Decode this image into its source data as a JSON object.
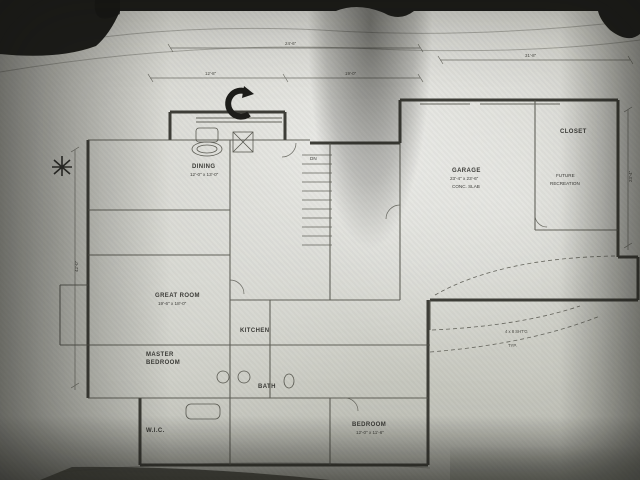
{
  "photo": {
    "subject": "architectural floor plan blueprint photograph"
  },
  "colors": {
    "paper": "#d0d1c9",
    "background": "#22221f",
    "wall_line": "#45453f",
    "thin_line": "#7b7b73"
  },
  "plan": {
    "rooms": {
      "great_room": {
        "label": "GREAT ROOM",
        "size": "19'-6\" x 18'-0\""
      },
      "master": {
        "label": "MASTER",
        "label2": "BEDROOM"
      },
      "dining": {
        "label": "DINING",
        "size": "12'-0\" x 13'-0\""
      },
      "kitchen": {
        "label": "KITCHEN"
      },
      "bath": {
        "label": "BATH"
      },
      "wic": {
        "label": "W.I.C."
      },
      "bedroom": {
        "label": "BEDROOM",
        "size": "12'-0\" x 11'-6\""
      },
      "garage": {
        "label": "GARAGE",
        "size": "23'-4\" x 23'-6\"",
        "note": "CONC. SLAB"
      },
      "closet": {
        "label": "CLOSET"
      },
      "future_room": {
        "label": "FUTURE",
        "label2": "RECREATION"
      },
      "stairs": {
        "label": "DN"
      }
    },
    "dimensions": {
      "top_left": "24'-6\"",
      "top_right": "31'-8\"",
      "mid_a": "12'-8\"",
      "mid_b": "19'-0\"",
      "right_side": "23'-4\"",
      "left_side": "42'-0\""
    },
    "notes": {
      "n1": "4 x 8 SHT'G",
      "n2": "TYP."
    }
  },
  "icons": {
    "north_arrow": "curved-north-arrow",
    "shrub": "shrub-symbol"
  }
}
